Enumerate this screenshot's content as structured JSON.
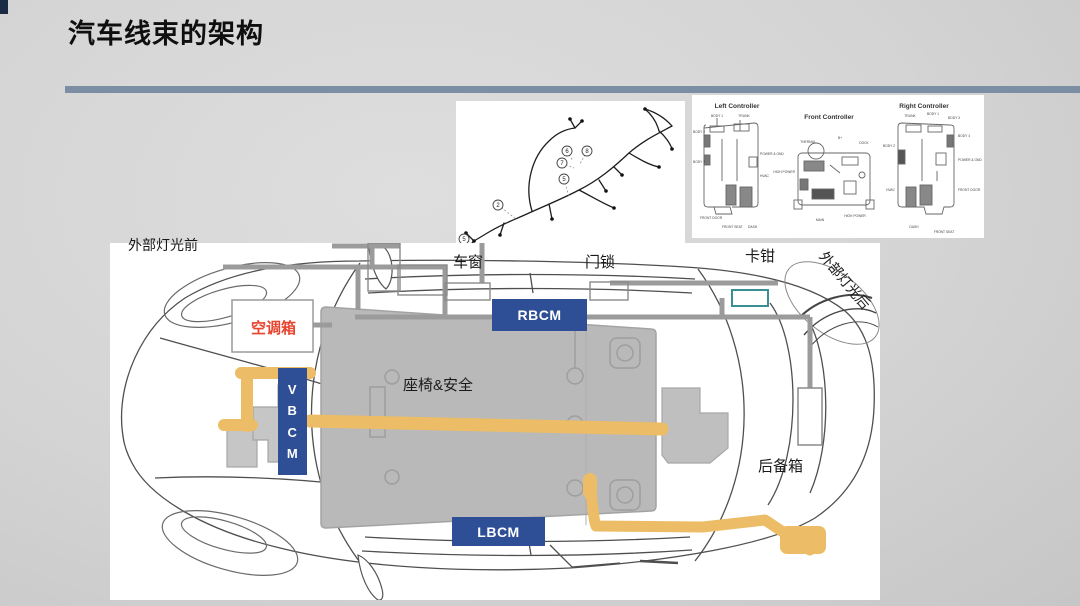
{
  "slide": {
    "title": "汽车线束的架构"
  },
  "figures": {
    "harness": {
      "callouts": {
        "c8": "8",
        "c6": "6",
        "c7": "7",
        "c5b": "5",
        "c2": "2",
        "c5a": "5"
      }
    },
    "controllers": {
      "left": {
        "title": "Left Controller",
        "labels": [
          "BODY 1",
          "TRUNK",
          "BODY 2",
          "BODY 3",
          "POWER & GND",
          "HVAC",
          "FRONT DOOR",
          "FRONT SEAT",
          "DASH"
        ]
      },
      "front": {
        "title": "Front Controller",
        "labels": [
          "THERMAL",
          "B+",
          "DOCK",
          "HIGH POWER",
          "MAIN",
          "HIGH POWER"
        ]
      },
      "right": {
        "title": "Right Controller",
        "labels": [
          "TRUNK",
          "BODY 1",
          "BODY 3",
          "BODY 2",
          "BODY 4",
          "POWER & GND",
          "HVAC",
          "FRONT DOOR",
          "DASH",
          "FRONT SEAT"
        ]
      }
    },
    "car": {
      "labels": {
        "front_lights": "外部灯光前",
        "window": "车窗",
        "door_lock": "门锁",
        "caliper": "卡钳",
        "rear_lights": "外部灯光后",
        "hvac_box": "空调箱",
        "seats_safety": "座椅&安全",
        "trunk": "后备箱"
      },
      "modules": {
        "rbcm": "RBCM",
        "vbcm": "VBCM",
        "lbcm": "LBCM"
      }
    }
  },
  "colors": {
    "module_blue": "#2e4f96",
    "harness_orange": "#ecbd66",
    "hvac_red": "#e8442f",
    "divider_slate": "#7c8ea4"
  }
}
